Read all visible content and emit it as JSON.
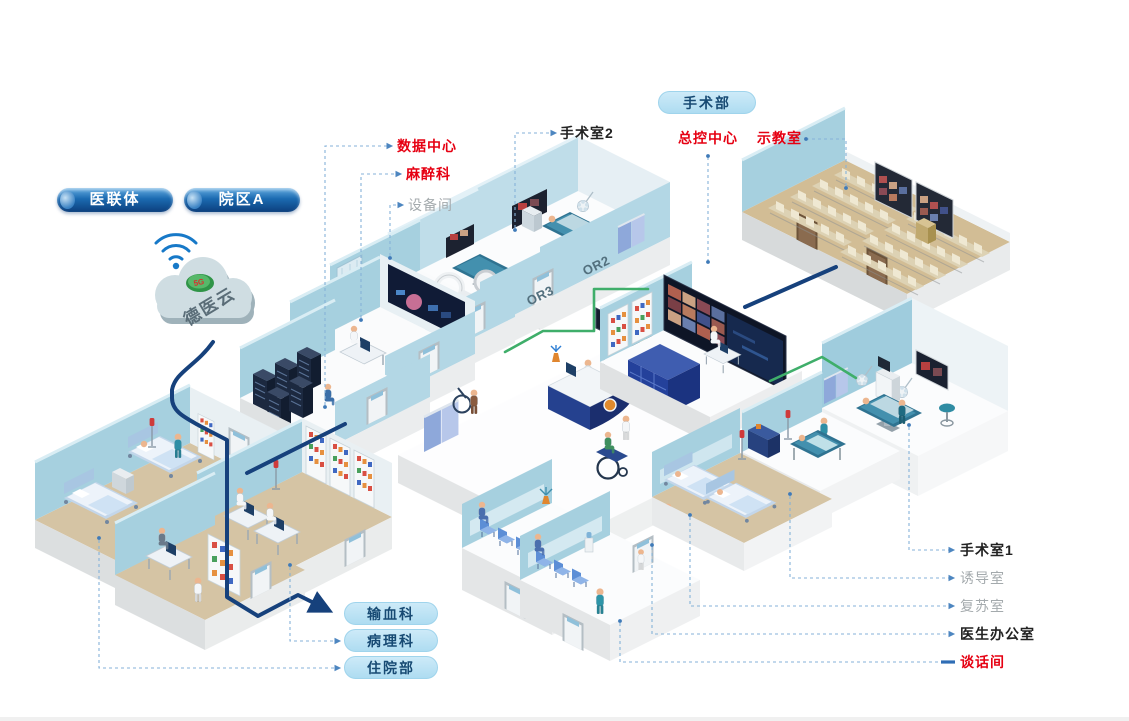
{
  "page": {
    "background": "#ffffff"
  },
  "cloud": {
    "label": "德医云",
    "badge": "5G"
  },
  "pills": {
    "alliance": "医联体",
    "campus": "院区A",
    "surgery_dept": "手术部",
    "blood": "输血科",
    "pathology": "病理科",
    "inpatient": "住院部"
  },
  "labels": {
    "data_center": "数据中心",
    "anesthesia": "麻醉科",
    "equipment_room": "设备间",
    "or2_room": "手术室2",
    "master_control": "总控中心",
    "demo_classroom": "示教室",
    "or1_room": "手术室1",
    "induction_room": "诱导室",
    "recovery_room": "复苏室",
    "doctor_office": "医生办公室",
    "talk_room": "谈话间"
  },
  "wall_tags": {
    "or2": "OR2",
    "or3": "OR3"
  },
  "colors": {
    "callout_red": "#e60012",
    "callout_gray": "#a4aaad",
    "callout_dark": "#222222",
    "leader_blue": "#85b2d8",
    "backbone_navy": "#16417c",
    "cable_green": "#3fae6a",
    "wall_teal": "#a6d0df",
    "floor_tan": "#d5c4a4",
    "pill_light_blue": "#aedcf1",
    "pill_dark_blue": "#0d4e95"
  }
}
